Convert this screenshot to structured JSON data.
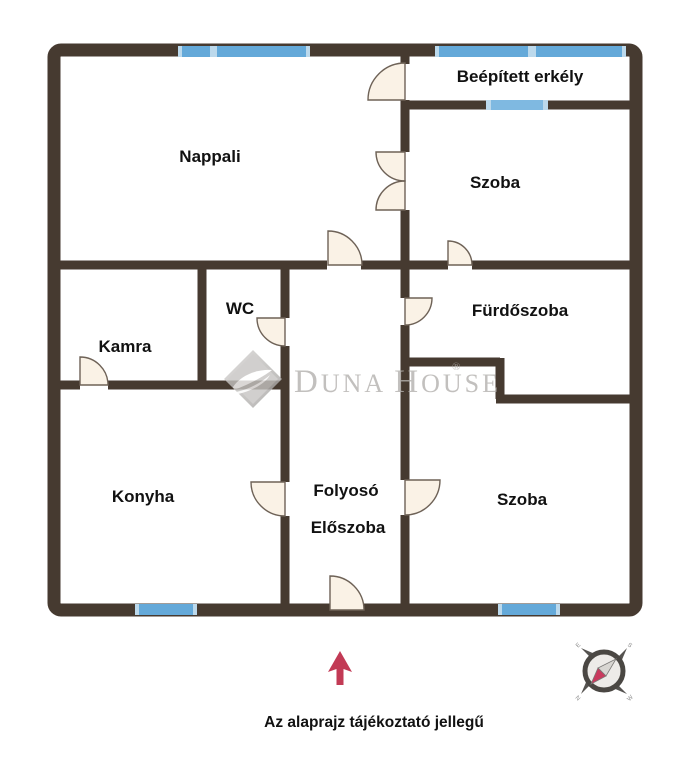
{
  "plan": {
    "rooms": [
      {
        "id": "nappali",
        "label": "Nappali"
      },
      {
        "id": "beepitett-erkely",
        "label": "Beépített erkély"
      },
      {
        "id": "szoba-felso",
        "label": "Szoba"
      },
      {
        "id": "wc",
        "label": "WC"
      },
      {
        "id": "kamra",
        "label": "Kamra"
      },
      {
        "id": "furdoszoba",
        "label": "Fürdőszoba"
      },
      {
        "id": "konyha",
        "label": "Konyha"
      },
      {
        "id": "folyoso",
        "label": "Folyosó"
      },
      {
        "id": "eloszoba",
        "label": "Előszoba"
      },
      {
        "id": "szoba-also",
        "label": "Szoba"
      }
    ],
    "caption": "Az alaprajz tájékoztató jellegű"
  },
  "watermark": {
    "parts": {
      "d": "D",
      "una": "UNA",
      "space": " ",
      "h": "H",
      "ouse": "OUSE"
    },
    "registered": "®"
  },
  "compass": {
    "letters": {
      "sw": "N",
      "nw": "E",
      "ne": "S",
      "se": "W"
    }
  },
  "colors": {
    "wall": "#463A30",
    "window_blue": "#64A9D9",
    "window_light": "#BCD9EC",
    "window_pale": "#7FB9E1",
    "door_fill": "#FAF2E6",
    "door_stroke": "#6E6257",
    "label": "#111111",
    "arrow_red": "#C23A55",
    "watermark_gray": "#B4B1AE",
    "logo_light": "#D3D1CF",
    "logo_dark": "#A9A7A5",
    "compass_ring": "#4A4743",
    "compass_face": "#EDEBE8",
    "needle_pink": "#C93A5E",
    "needle_gray": "#D8D6D2"
  }
}
